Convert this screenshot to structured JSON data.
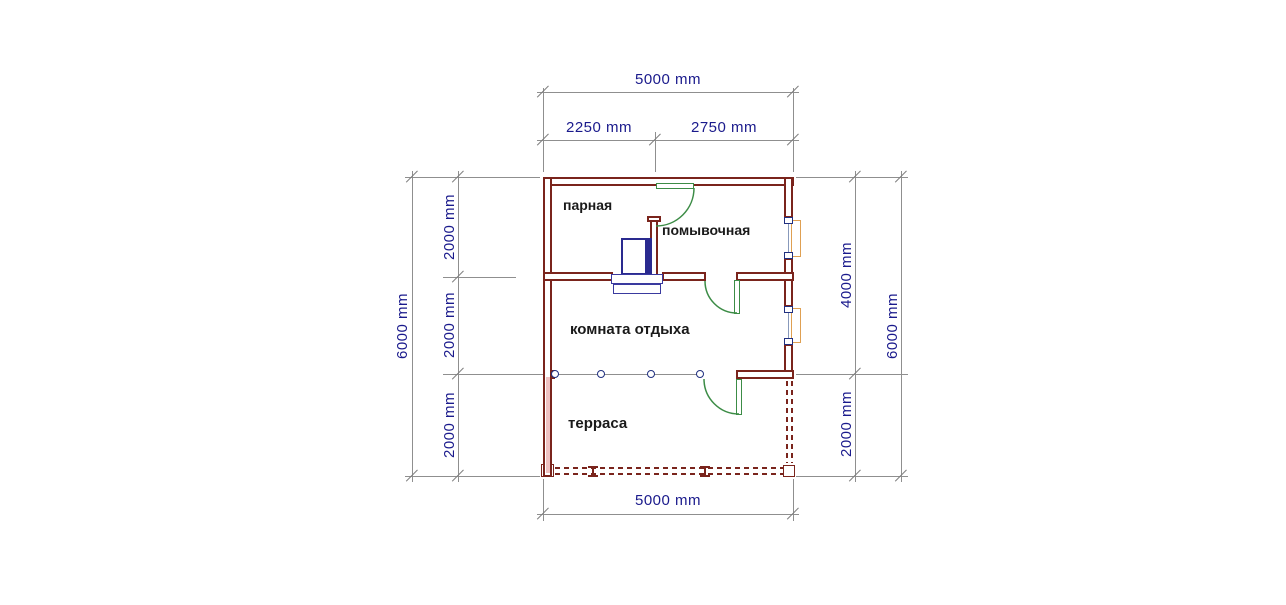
{
  "rooms": {
    "steam": "парная",
    "washing": "помывочная",
    "lounge": "комната отдыха",
    "terrace": "терраса"
  },
  "dims": {
    "top_total": "5000 mm",
    "top_left": "2250 mm",
    "top_right": "2750 mm",
    "left_total": "6000 mm",
    "left_seg_1": "2000 mm",
    "left_seg_2": "2000 mm",
    "left_seg_3": "2000 mm",
    "right_upper": "4000 mm",
    "right_lower": "2000 mm",
    "right_total": "6000 mm",
    "bottom_total": "5000 mm"
  },
  "colors": {
    "wall": "#7a241c",
    "wall_fill_pink": "#f0c2c2",
    "door": "#3c8c46",
    "stove": "#2a2a8f",
    "window_frame": "#dfa052",
    "window_marker": "#203080",
    "dimension_line": "#8f8f8f",
    "dimension_text": "#1a1a8c",
    "label_text": "#1a1a1a"
  }
}
